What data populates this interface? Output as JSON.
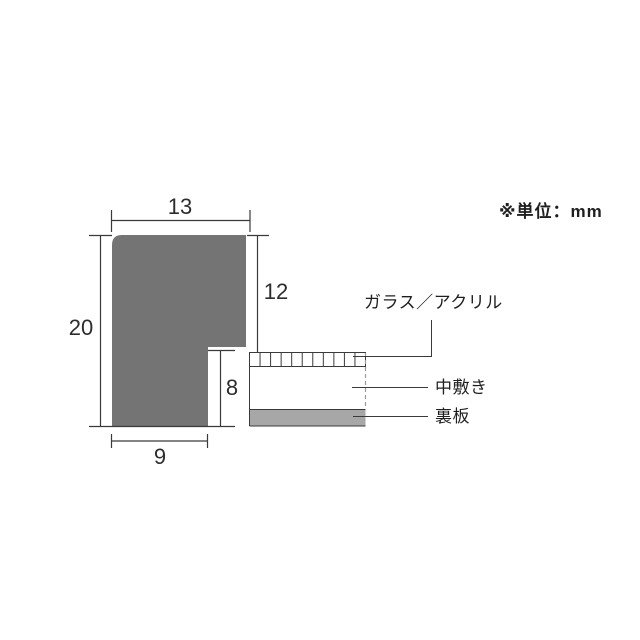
{
  "unit_note": "※単位：mm",
  "dimensions": {
    "top_width": "13",
    "left_height": "20",
    "rabbet_depth": "12",
    "lower_inner_height": "8",
    "bottom_width": "9"
  },
  "labels": {
    "glass": "ガラス／アクリル",
    "mat": "中敷き",
    "backboard": "裏板"
  },
  "colors": {
    "frame_fill": "#747474",
    "backboard_fill": "#a7a7a7",
    "line": "#3a3a3a",
    "dash": "#9b9b9b",
    "background": "#ffffff"
  }
}
